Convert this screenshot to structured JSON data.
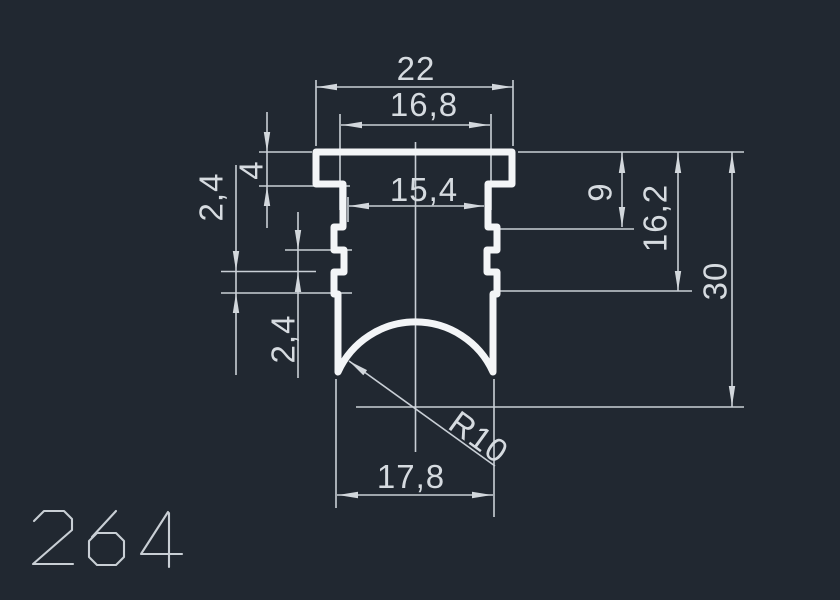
{
  "part_number": "264",
  "canvas": {
    "background_color": "#212831",
    "profile_line_color": "#f3f5f7",
    "dimension_line_color": "#c9cfd6",
    "text_color": "#d6dbe0"
  },
  "dimensions": {
    "overall_width": "22",
    "flange_inner_width": "16,8",
    "neck_width": "15,4",
    "flange_height": "4",
    "rib_step_upper": "2,4",
    "rib_step_lower": "2,4",
    "depth_to_first_rib": "9",
    "depth_to_last_rib": "16,2",
    "overall_height": "30",
    "leg_span": "17,8",
    "arc_radius": "R10"
  }
}
